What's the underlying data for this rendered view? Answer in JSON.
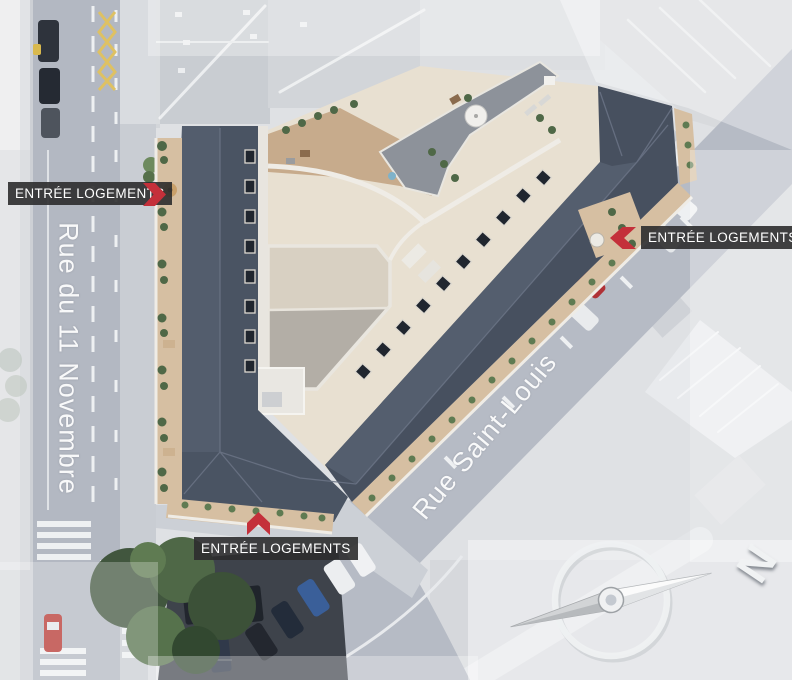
{
  "view": {
    "description": "Aerial rendering of a residential block with annotated housing entrances"
  },
  "entrance_labels": [
    {
      "text": "ENTRÉE LOGEMENTS",
      "position": "left",
      "arrow_direction": "right"
    },
    {
      "text": "ENTRÉE LOGEMENTS",
      "position": "right",
      "arrow_direction": "left"
    },
    {
      "text": "ENTRÉE LOGEMENTS",
      "position": "bottom",
      "arrow_direction": "up"
    }
  ],
  "streets": [
    {
      "name": "Rue du 11 Novembre",
      "orientation": "vertical-left"
    },
    {
      "name": "Rue Saint-Louis",
      "orientation": "diagonal"
    }
  ],
  "compass": {
    "north_label": "N",
    "needle_points": "upper-right"
  },
  "colors": {
    "roof_slate": "#4d5766",
    "courtyard_cream": "#e8e0d1",
    "balcony_tan": "#d6bfa2",
    "terrace_tan": "#c7ab8c",
    "plants_green": "#4f6847",
    "street_gray": "#b2b7c1",
    "accent_red": "#c4303a",
    "label_background": "#2c2c2e",
    "label_text": "#ffffff"
  }
}
